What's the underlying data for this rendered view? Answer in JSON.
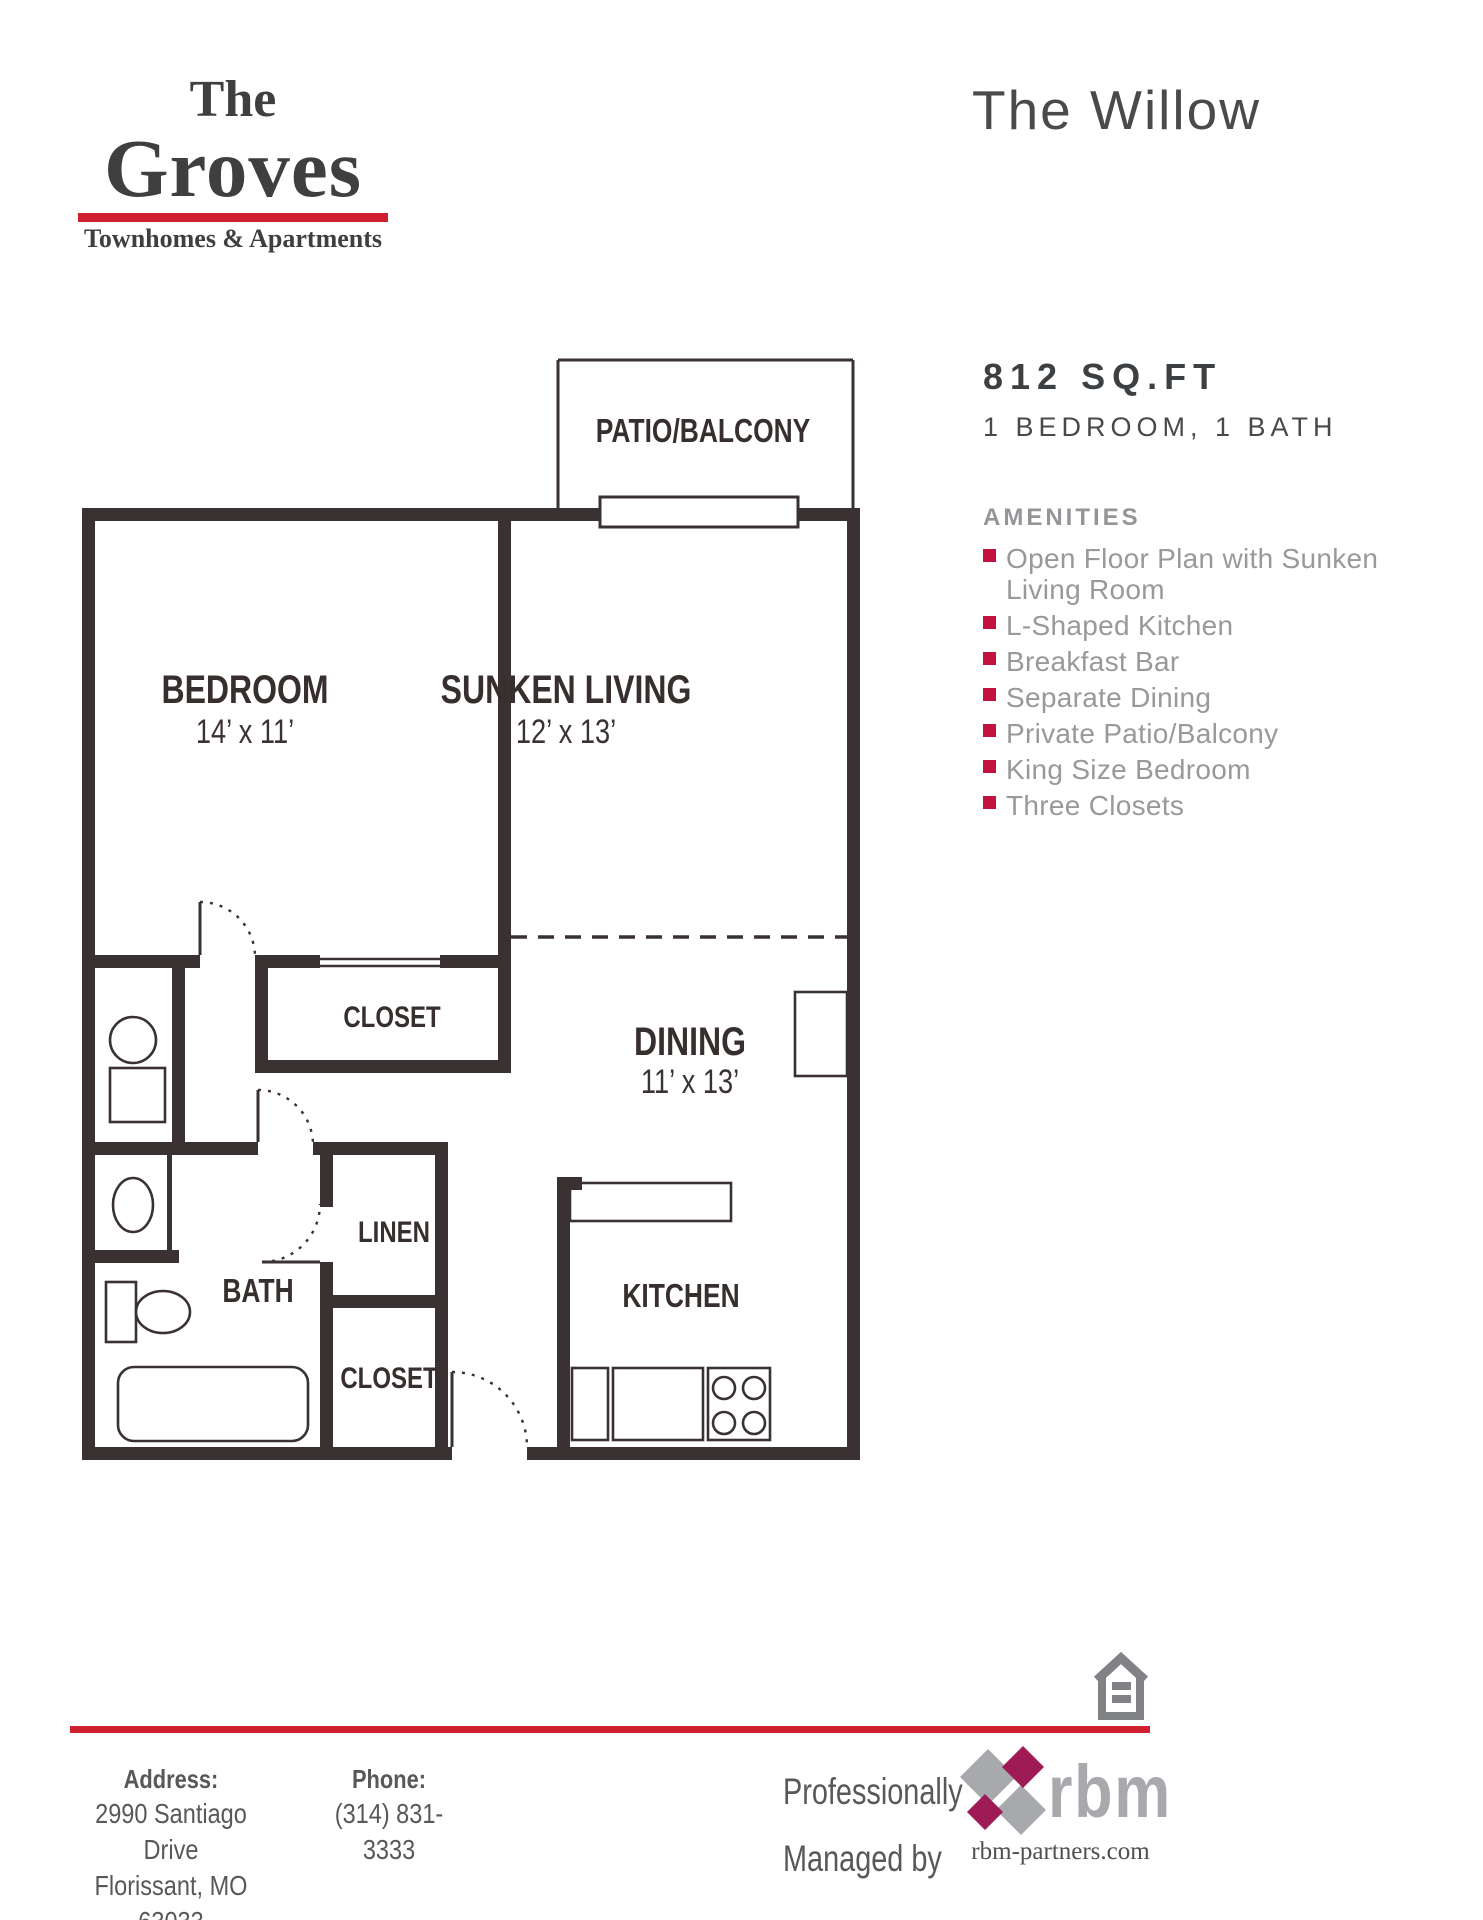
{
  "brand": {
    "the": "The",
    "name": "Groves",
    "tagline": "Townhomes & Apartments"
  },
  "header": {
    "plan_title": "The Willow"
  },
  "summary": {
    "sqft": "812 SQ.FT",
    "config": "1 BEDROOM, 1 BATH"
  },
  "amenities": {
    "header": "AMENITIES",
    "items": [
      {
        "line1": "Open Floor Plan with Sunken",
        "line2": "Living Room"
      },
      {
        "line1": "L-Shaped Kitchen",
        "line2": ""
      },
      {
        "line1": "Breakfast Bar",
        "line2": ""
      },
      {
        "line1": "Separate Dining",
        "line2": ""
      },
      {
        "line1": "Private Patio/Balcony",
        "line2": ""
      },
      {
        "line1": "King Size Bedroom",
        "line2": ""
      },
      {
        "line1": "Three Closets",
        "line2": ""
      }
    ]
  },
  "floorplan": {
    "patio": {
      "name": "PATIO/BALCONY"
    },
    "bedroom": {
      "name": "BEDROOM",
      "dims": "14’ x 11’"
    },
    "living": {
      "name": "SUNKEN LIVING",
      "dims": "12’ x 13’"
    },
    "dining": {
      "name": "DINING",
      "dims": "11’ x 13’"
    },
    "closet_hall": {
      "name": "CLOSET"
    },
    "linen": {
      "name": "LINEN"
    },
    "bath": {
      "name": "BATH"
    },
    "closet_entry": {
      "name": "CLOSET"
    },
    "kitchen": {
      "name": "KITCHEN"
    }
  },
  "footer": {
    "address_label": "Address:",
    "address_line1": "2990 Santiago Drive",
    "address_line2": "Florissant, MO 63033",
    "phone_label": "Phone:",
    "phone_number": "(314) 831-3333",
    "managed_line1": "Professionally",
    "managed_line2": "Managed by",
    "rbm_name": "rbm",
    "rbm_site": "rbm-partners.com"
  },
  "colors": {
    "wall": "#3a3133",
    "brand_red": "#d02030",
    "bullet_red": "#c41240",
    "amenity_gray": "#97999b",
    "rbm_gray": "#a7a9ac",
    "rbm_magenta": "#9e1b56",
    "house_icon_gray": "#808285"
  }
}
